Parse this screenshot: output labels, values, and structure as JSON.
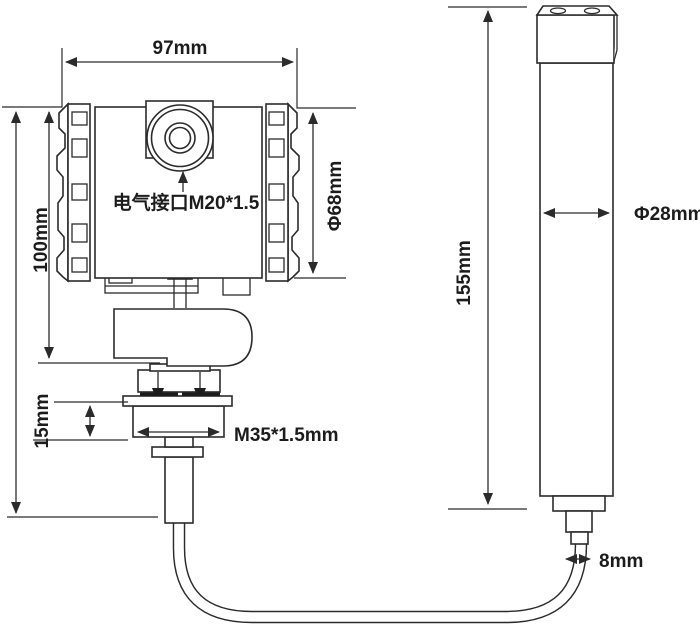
{
  "diagram": {
    "dimensions": {
      "housing_width": "97mm",
      "housing_height": "100mm",
      "electrical_interface": "电气接口M20*1.5",
      "housing_diameter": "Φ68mm",
      "thread_length": "15mm",
      "process_thread": "M35*1.5mm",
      "probe_length": "155mm",
      "probe_diameter": "Φ28mm",
      "cable_diameter": "8mm"
    },
    "colors": {
      "line": "#2b2b2b",
      "text": "#1c1c1c",
      "background": "#ffffff"
    }
  }
}
